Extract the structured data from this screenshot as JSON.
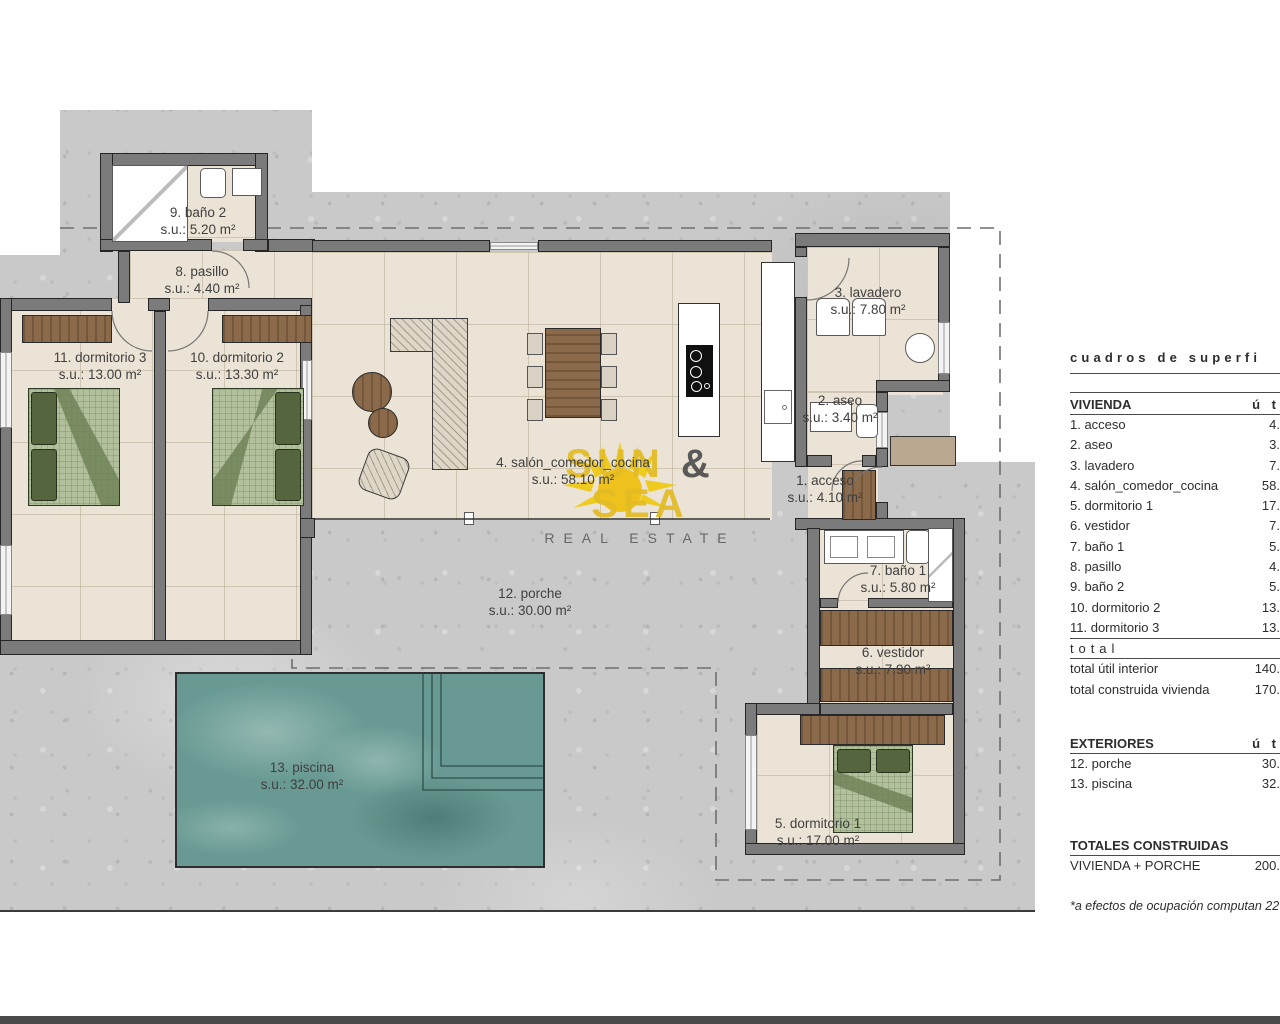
{
  "floorplan": {
    "rooms": [
      {
        "name": "1. acceso",
        "area": "s.u.: 4.10 m²"
      },
      {
        "name": "2. aseo",
        "area": "s.u.: 3.40 m²"
      },
      {
        "name": "3. lavadero",
        "area": "s.u.: 7.80 m²"
      },
      {
        "name": "4. salón_comedor_cocina",
        "area": "s.u.: 58.10 m²"
      },
      {
        "name": "5. dormitorio 1",
        "area": "s.u.: 17.00 m²"
      },
      {
        "name": "6. vestidor",
        "area": "s.u.: 7.90 m²"
      },
      {
        "name": "7. baño 1",
        "area": "s.u.: 5.80 m²"
      },
      {
        "name": "8. pasillo",
        "area": "s.u.: 4.40 m²"
      },
      {
        "name": "9. baño 2",
        "area": "s.u.: 5.20 m²"
      },
      {
        "name": "10. dormitorio 2",
        "area": "s.u.: 13.30 m²"
      },
      {
        "name": "11. dormitorio 3",
        "area": "s.u.: 13.00 m²"
      },
      {
        "name": "12. porche",
        "area": "s.u.: 30.00 m²"
      },
      {
        "name": "13. piscina",
        "area": "s.u.: 32.00 m²"
      }
    ],
    "watermark": {
      "word1": "SUN",
      "amp": "&",
      "word2": "SEA",
      "subtitle": "REAL ESTATE"
    },
    "colors": {
      "wall": "#7b7b7b",
      "floor": "#ebe3d5",
      "plot": "#c9c9c9",
      "pool": "#689a93",
      "furniture_brown": "#8a6a4b",
      "bed_green": "#b2c09c",
      "logo_yellow": "#e3bc25"
    }
  },
  "sidebar": {
    "title": "cuadros de superfi",
    "vivienda": {
      "header": "VIVIENDA",
      "unit_col": "ú t",
      "rows": [
        {
          "label": "1. acceso",
          "value": "4."
        },
        {
          "label": "2. aseo",
          "value": "3."
        },
        {
          "label": "3. lavadero",
          "value": "7."
        },
        {
          "label": "4. salón_comedor_cocina",
          "value": "58."
        },
        {
          "label": "5. dormitorio 1",
          "value": "17."
        },
        {
          "label": "6. vestidor",
          "value": "7."
        },
        {
          "label": "7. baño 1",
          "value": "5."
        },
        {
          "label": "8. pasillo",
          "value": "4."
        },
        {
          "label": "9. baño 2",
          "value": "5."
        },
        {
          "label": "10. dormitorio 2",
          "value": "13."
        },
        {
          "label": "11. dormitorio 3",
          "value": "13."
        }
      ],
      "total_divider": "total",
      "totals": [
        {
          "label": "total útil interior",
          "value": "140."
        },
        {
          "label": "total construida vivienda",
          "value": "170."
        }
      ]
    },
    "exteriores": {
      "header": "EXTERIORES",
      "unit_col": "ú t",
      "rows": [
        {
          "label": "12. porche",
          "value": "30."
        },
        {
          "label": "13. piscina",
          "value": "32."
        }
      ]
    },
    "totales": {
      "header": "TOTALES CONSTRUIDAS",
      "rows": [
        {
          "label": "VIVIENDA + PORCHE",
          "value": "200."
        }
      ]
    },
    "footnote": "*a efectos de ocupación computan 227."
  }
}
